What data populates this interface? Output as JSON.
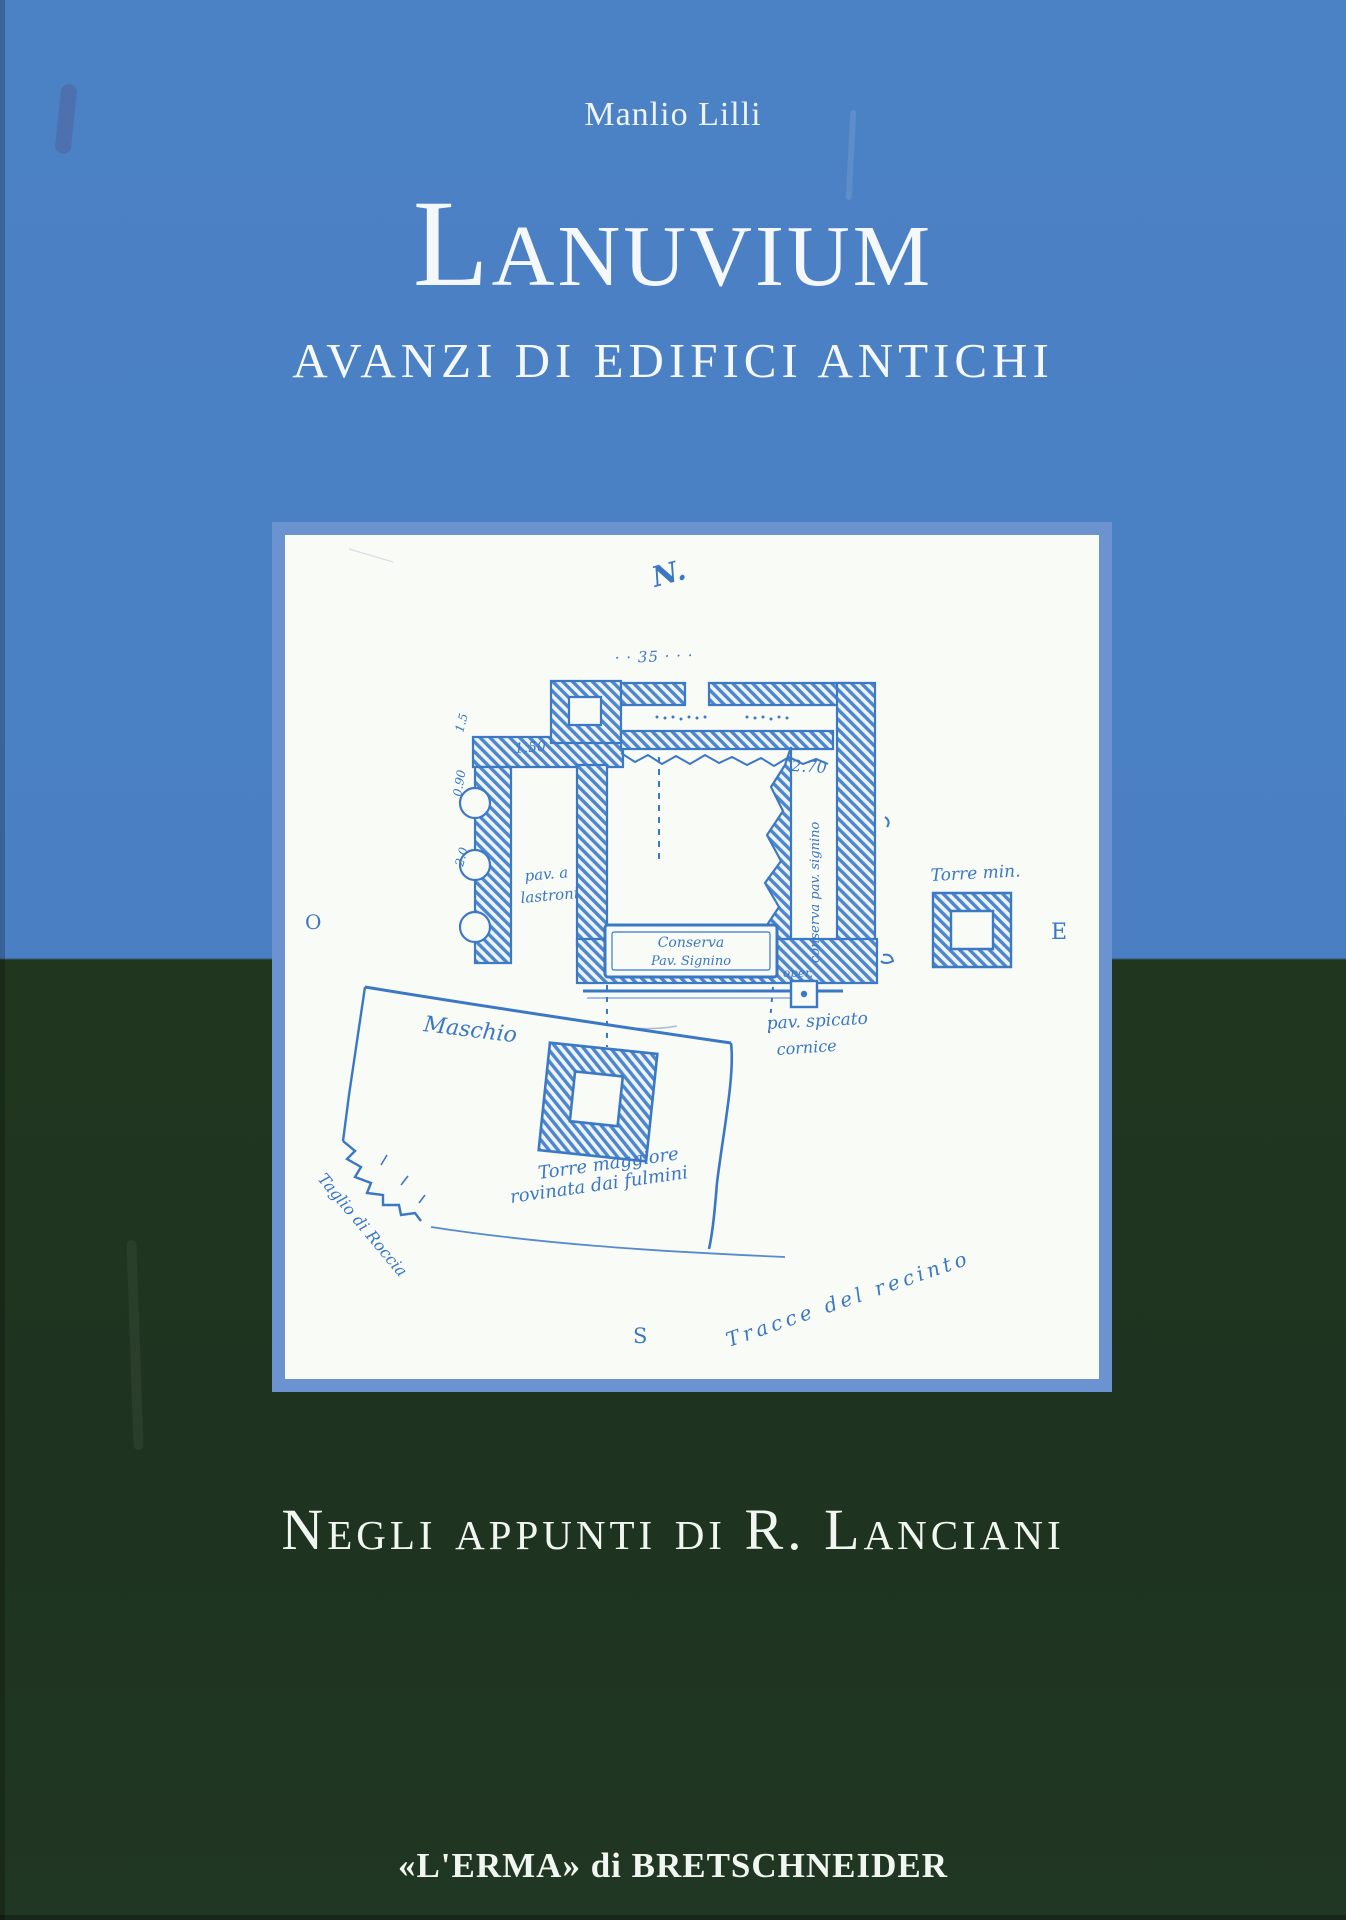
{
  "cover": {
    "author": "Manlio Lilli",
    "title": "Lanuvium",
    "subtitle": "AVANZI DI EDIFICI ANTICHI",
    "series_line": "Negli appunti di R. Lanciani",
    "publisher": "«L'ERMA» di BRETSCHNEIDER"
  },
  "colors": {
    "top_background": "#4a7fc3",
    "bottom_background": "#1f3521",
    "panel_frame": "#6a93d0",
    "panel_paper": "#f9fbf7",
    "sketch_ink": "#3a77c5",
    "cover_text": "#f2f6f1"
  },
  "sketch": {
    "description": "hand-drawn plan of ancient ruins (Lanciani notebook sketch)",
    "labels": {
      "north": "N.",
      "measure_35": "· ·  35 · · ·",
      "measure_150": "1.50",
      "measure_270": "2.70",
      "measure_15": "1.5",
      "measure_090": "0.90",
      "measure_20": "2.0",
      "pav_lastroni_1": "pav. a",
      "pav_lastroni_2": "lastroni",
      "conserva_vertical": "conserva pav. signino",
      "conserva_box_1": "Conserva",
      "conserva_box_2": "Pav. Signino",
      "oper": "oper.",
      "pav_spicato": "pav. spicato",
      "cornice": "cornice",
      "torre_min": "Torre min.",
      "east": "E",
      "west": "O",
      "south": "S",
      "maschio": "Maschio",
      "torre_maggiore_1": "Torre maggiore",
      "torre_maggiore_2": "rovinata dai fulmini",
      "taglio_roccia": "Taglio di Roccia",
      "tracce_recinto": "Tracce del recinto"
    }
  }
}
